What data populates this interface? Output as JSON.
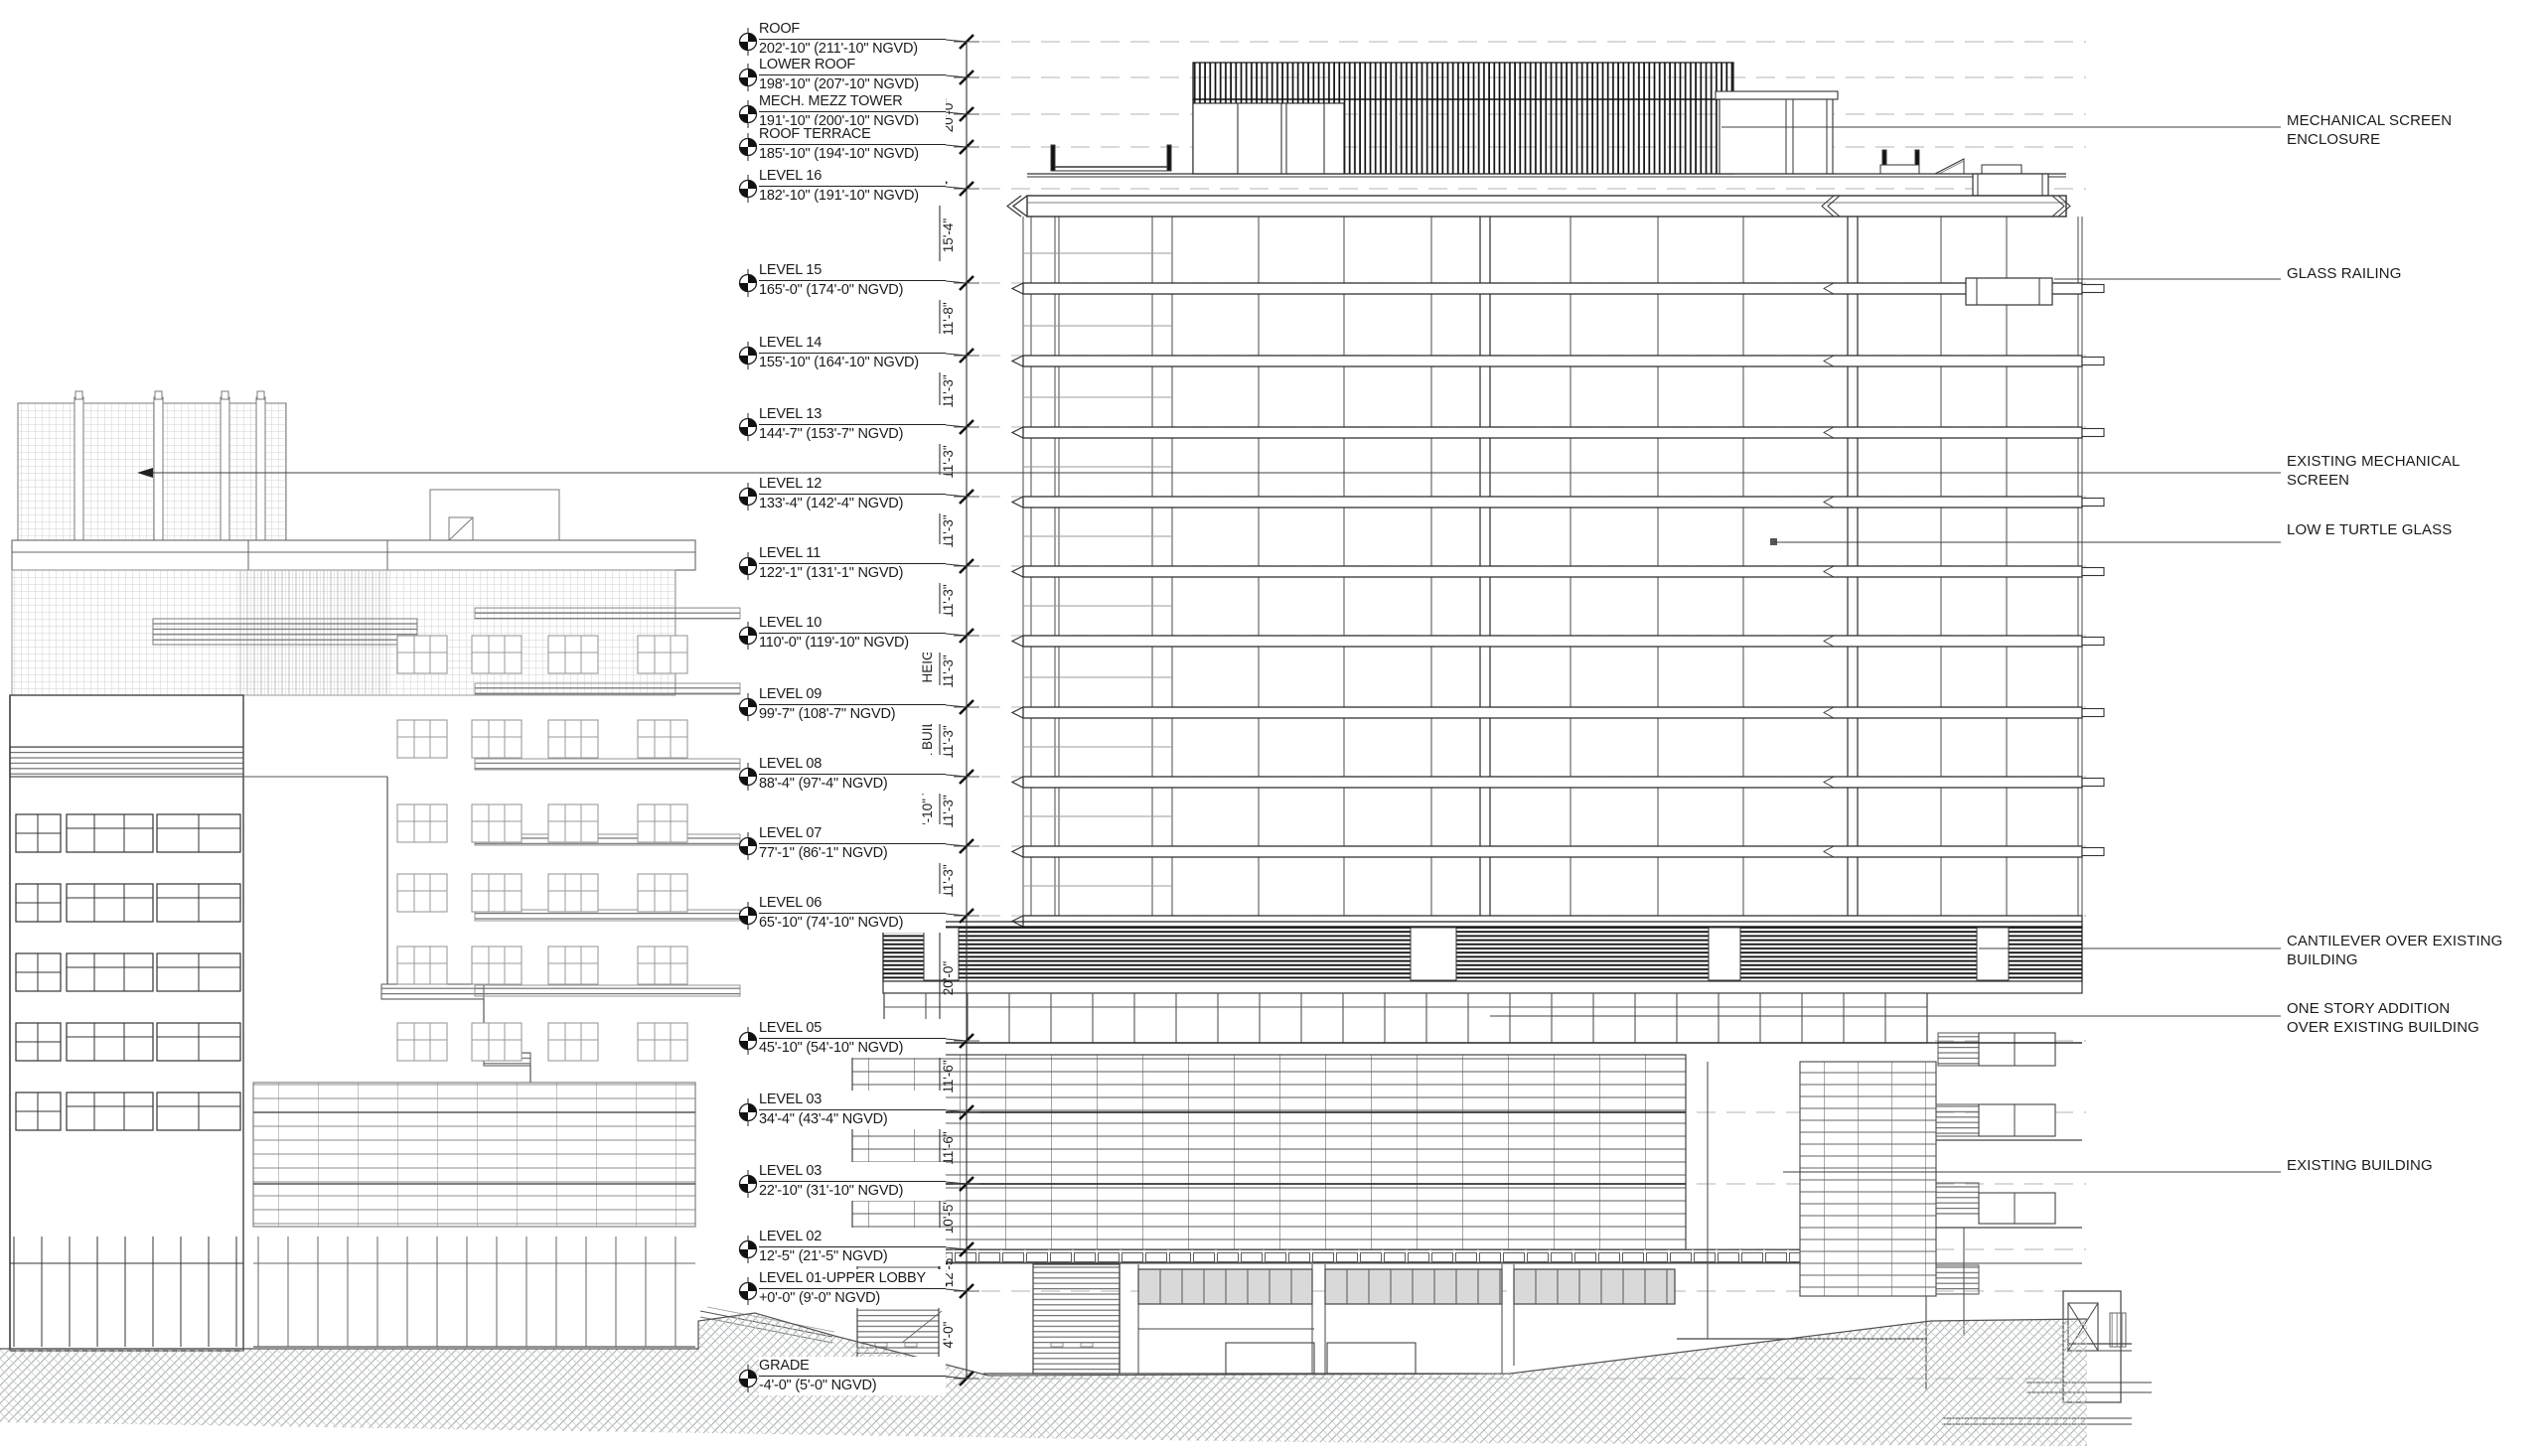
{
  "drawing": {
    "levels": [
      {
        "name": "ROOF",
        "elev": "202'-10\" (211'-10\" NGVD)"
      },
      {
        "name": "LOWER ROOF",
        "elev": "198'-10\" (207'-10\" NGVD)"
      },
      {
        "name": "MECH. MEZZ TOWER",
        "elev": "191'-10\" (200'-10\" NGVD)"
      },
      {
        "name": "ROOF TERRACE",
        "elev": "185'-10\" (194'-10\" NGVD)"
      },
      {
        "name": "LEVEL 16",
        "elev": "182'-10\" (191'-10\" NGVD)"
      },
      {
        "name": "LEVEL 15",
        "elev": "165'-0\" (174'-0\" NGVD)"
      },
      {
        "name": "LEVEL 14",
        "elev": "155'-10\" (164'-10\" NGVD)"
      },
      {
        "name": "LEVEL 13",
        "elev": "144'-7\" (153'-7\" NGVD)"
      },
      {
        "name": "LEVEL 12",
        "elev": "133'-4\" (142'-4\" NGVD)"
      },
      {
        "name": "LEVEL 11",
        "elev": "122'-1\" (131'-1\" NGVD)"
      },
      {
        "name": "LEVEL 10",
        "elev": "110'-0\" (119'-10\" NGVD)"
      },
      {
        "name": "LEVEL 09",
        "elev": "99'-7\" (108'-7\" NGVD)"
      },
      {
        "name": "LEVEL 08",
        "elev": "88'-4\" (97'-4\" NGVD)"
      },
      {
        "name": "LEVEL 07",
        "elev": "77'-1\" (86'-1\" NGVD)"
      },
      {
        "name": "LEVEL 06",
        "elev": "65'-10\" (74'-10\" NGVD)"
      },
      {
        "name": "LEVEL 05",
        "elev": "45'-10\" (54'-10\" NGVD)"
      },
      {
        "name": "LEVEL 03",
        "elev": "34'-4\" (43'-4\" NGVD)"
      },
      {
        "name": "LEVEL 03",
        "elev": "22'-10\" (31'-10\" NGVD)"
      },
      {
        "name": "LEVEL 02",
        "elev": "12'-5\" (21'-5\" NGVD)"
      },
      {
        "name": "LEVEL 01-UPPER LOBBY",
        "elev": "+0'-0\" (9'-0\" NGVD)"
      },
      {
        "name": "GRADE",
        "elev": "-4'-0\" (5'-0\" NGVD)"
      }
    ],
    "dims": [
      "20'-0\"",
      "15'-4\"",
      "11'-8\"",
      "11'-3\"",
      "11'-3\"",
      "11'-3\"",
      "11'-3\"",
      "11'-3\"",
      "11'-3\"",
      "11'-3\"",
      "11'-3\"",
      "20'-0\"",
      "11'-6\"",
      "11'-6\"",
      "10'-5\"",
      "12'-5\"",
      "4'-0\""
    ],
    "total_dim": "182'-10\" TOTAL BUILDING HEIGHT",
    "annotations": [
      {
        "lines": [
          "MECHANICAL SCREEN",
          "ENCLOSURE"
        ]
      },
      {
        "lines": [
          "GLASS RAILING"
        ]
      },
      {
        "lines": [
          "EXISTING MECHANICAL",
          "SCREEN"
        ]
      },
      {
        "lines": [
          "LOW E TURTLE GLASS"
        ]
      },
      {
        "lines": [
          "CANTILEVER OVER EXISTING",
          "BUILDING"
        ]
      },
      {
        "lines": [
          "ONE STORY ADDITION",
          "OVER EXISTING BUILDING"
        ]
      },
      {
        "lines": [
          "EXISTING BUILDING"
        ]
      }
    ],
    "colors": {
      "line": "#3a3a3a",
      "light_line": "#9a9a9a",
      "dashed": "#c2c2c2",
      "hatch": "#b0b5b8",
      "dark_band": "#141414"
    }
  }
}
